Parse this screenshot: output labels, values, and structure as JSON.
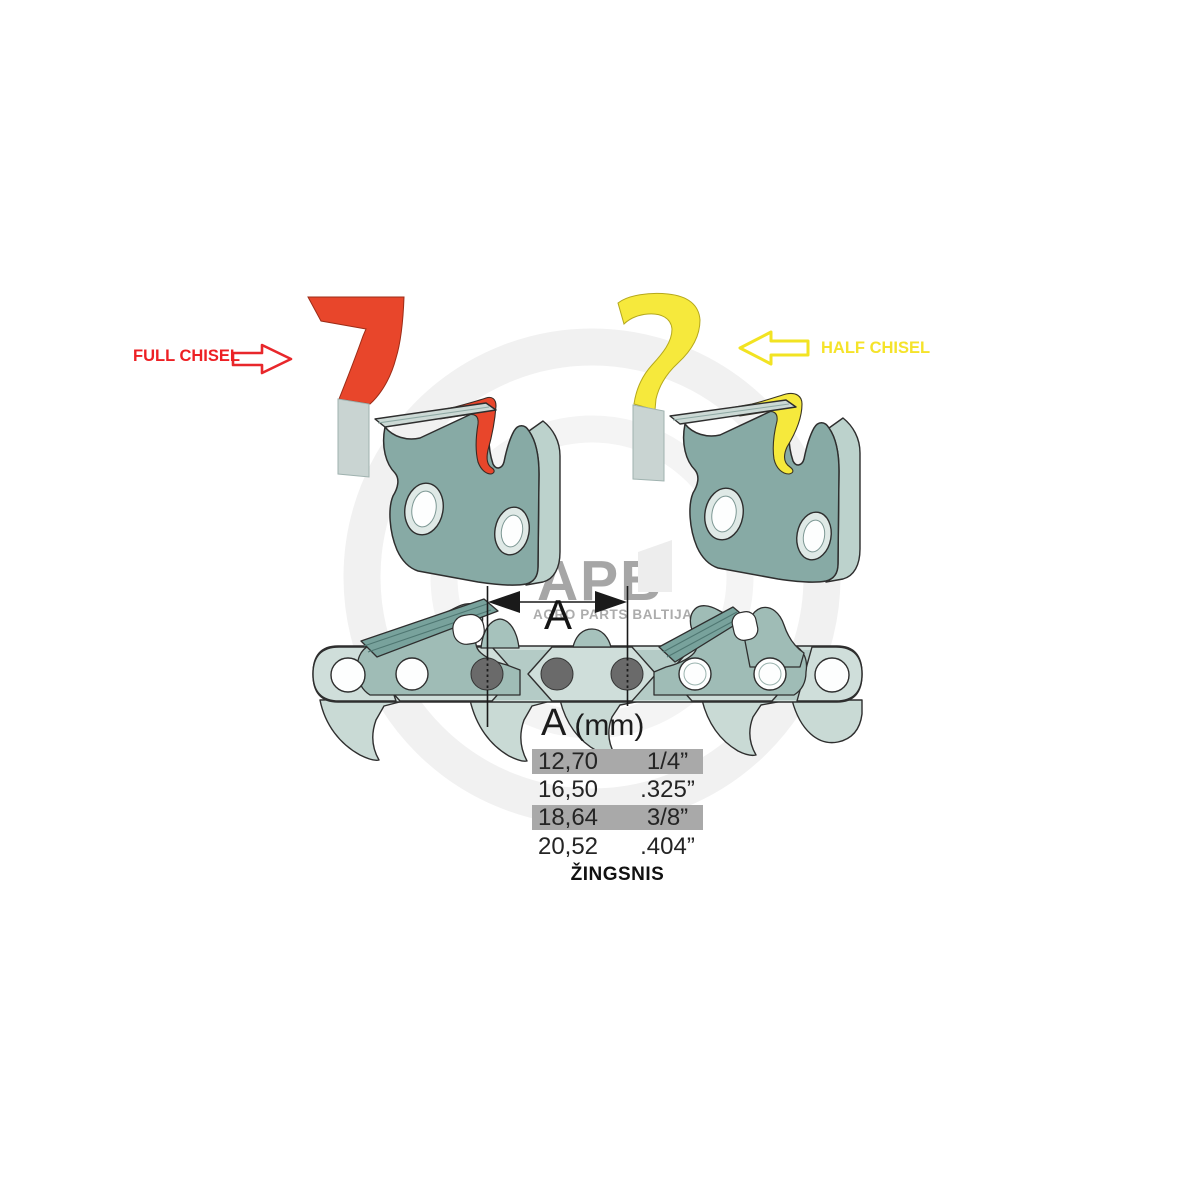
{
  "watermark": {
    "brand": "APB",
    "subtitle": "AGRO PARTS BALTIJA",
    "text_color": "#a6a6a6",
    "ring_color": "#f1f1f1"
  },
  "annotations": {
    "full_chisel_label": "FULL CHISEL",
    "half_chisel_label": "HALF CHISEL",
    "pitch_dimension_label": "A"
  },
  "pitch_table": {
    "header_symbol": "A",
    "header_unit": "(mm)",
    "rows": [
      {
        "mm": "12,70",
        "inches": "1/4”",
        "highlighted": true
      },
      {
        "mm": "16,50",
        "inches": ".325”",
        "highlighted": false
      },
      {
        "mm": "18,64",
        "inches": "3/8”",
        "highlighted": true
      },
      {
        "mm": "20,52",
        "inches": ".404”",
        "highlighted": false
      }
    ],
    "caption": "ŽINGSNIS",
    "highlight_color": "#a9a9a9"
  },
  "colors": {
    "full_chisel_accent": "#e8462b",
    "full_chisel_text": "#ed2024",
    "half_chisel_accent": "#f6e93c",
    "half_chisel_text": "#f5e32a",
    "chain_light": "#cfdeda",
    "chain_mid": "#9fbcb6",
    "chain_dark": "#7aa39d",
    "cutter_front": "#87aaa5",
    "cutter_side": "#bcd2cc",
    "rivet_gray": "#6a6a6a",
    "outline": "#2e2e2e"
  }
}
